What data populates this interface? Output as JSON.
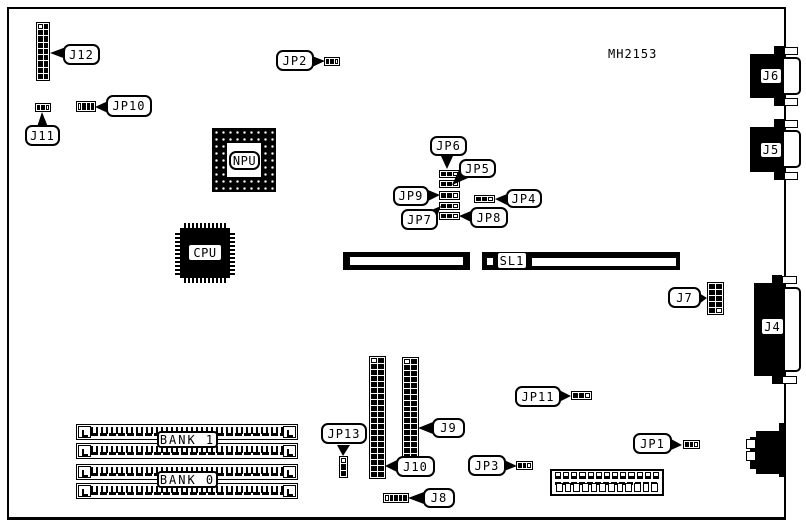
{
  "diagram": {
    "part_number": "MH2153"
  },
  "chips": {
    "cpu": "CPU",
    "npu": "NPU"
  },
  "slots": {
    "sl1": "SL1"
  },
  "memory_banks": {
    "bank0": "BANK 0",
    "bank1": "BANK 1"
  },
  "connectors": {
    "j4": "J4",
    "j5": "J5",
    "j6": "J6",
    "j7": "J7",
    "j8": "J8",
    "j9": "J9",
    "j10": "J10",
    "j11": "J11",
    "j12": "J12"
  },
  "jumpers": {
    "jp1": "JP1",
    "jp2": "JP2",
    "jp3": "JP3",
    "jp4": "JP4",
    "jp5": "JP5",
    "jp6": "JP6",
    "jp7": "JP7",
    "jp8": "JP8",
    "jp9": "JP9",
    "jp10": "JP10",
    "jp11": "JP11",
    "jp13": "JP13"
  },
  "colors": {
    "ink": "#000000",
    "paper": "#ffffff"
  }
}
